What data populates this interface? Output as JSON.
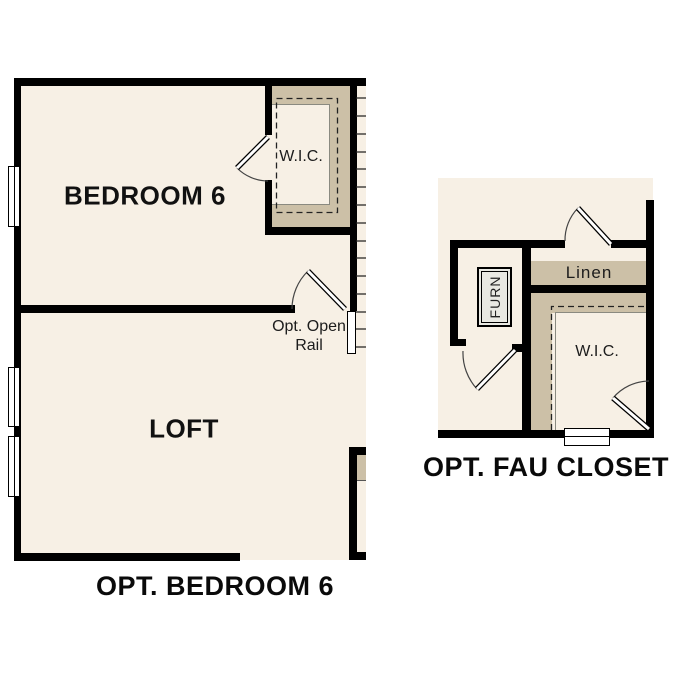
{
  "colors": {
    "background": "#ffffff",
    "floor": "#f7f0e5",
    "shelf": "#ccc0a7",
    "wall": "#000000",
    "furnace_fill": "#e9e9e3"
  },
  "plan_bedroom6": {
    "title": "OPT. BEDROOM 6",
    "bedroom_label": "BEDROOM 6",
    "loft_label": "LOFT",
    "wic_label": "W.I.C.",
    "rail_label_line1": "Opt. Open",
    "rail_label_line2": "Rail"
  },
  "plan_fau": {
    "title": "OPT. FAU CLOSET",
    "furnace_label": "FURN",
    "linen_label": "Linen",
    "wic_label": "W.I.C."
  }
}
